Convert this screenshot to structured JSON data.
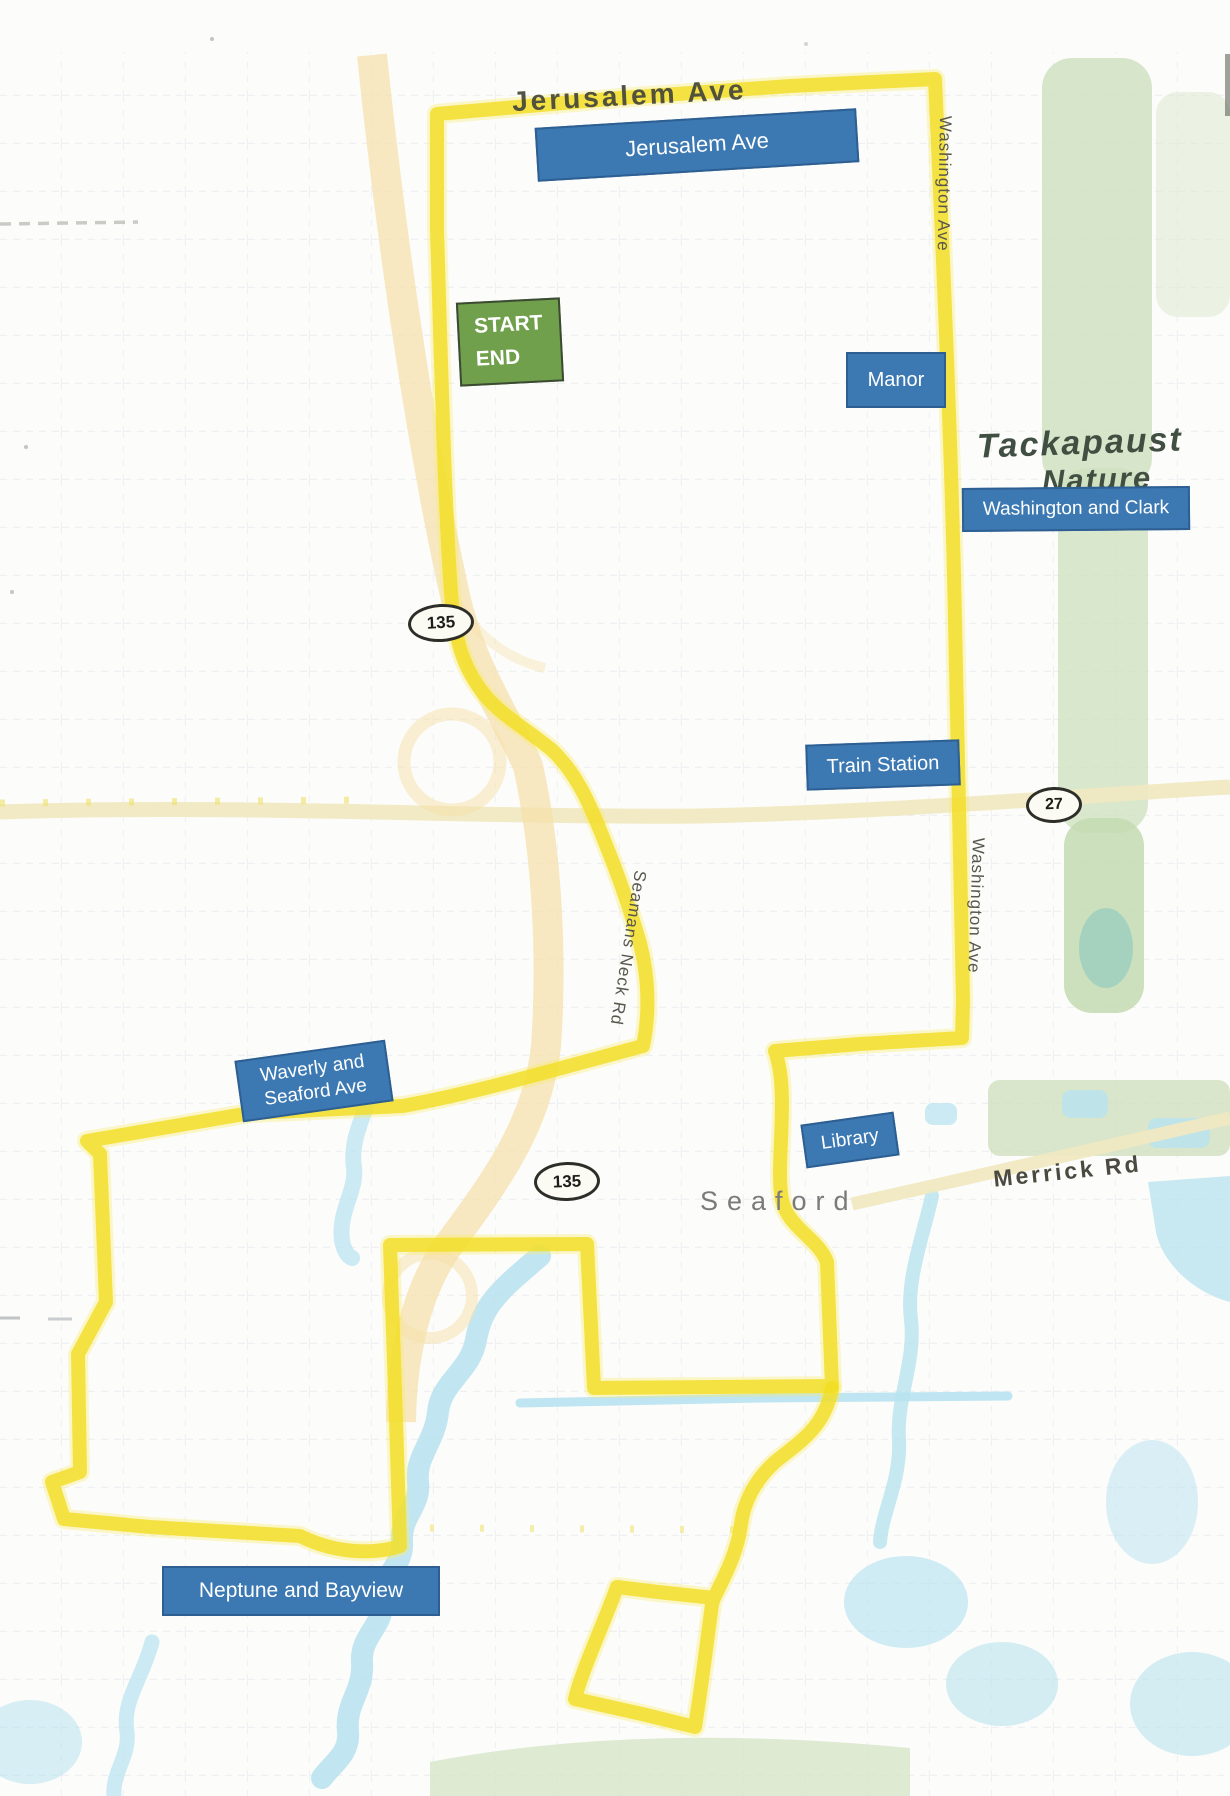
{
  "map": {
    "street_names": {
      "jerusalem_ave": "Jerusalem Ave",
      "washington_ave_north": "Washington Ave",
      "washington_ave_south": "Washington Ave",
      "seamans_neck_rd": "Seamans Neck Rd",
      "merrick_rd": "Merrick Rd"
    },
    "place_names": {
      "town": "Seaford",
      "preserve_line1": "Tackapaust",
      "preserve_line2": "Nature"
    },
    "shields": {
      "route_135_north": "135",
      "route_135_south": "135",
      "route_27": "27"
    },
    "route_stops": {
      "jerusalem_ave": "Jerusalem Ave",
      "manor": "Manor",
      "washington_and_clark": "Washington and Clark",
      "train_station": "Train Station",
      "waverly_line1": "Waverly and",
      "waverly_line2": "Seaford Ave",
      "library": "Library",
      "neptune_and_bayview": "Neptune and Bayview"
    },
    "start_marker": {
      "line1": "START",
      "line2": "END"
    },
    "colors": {
      "route_highlighter": "#f3dd22",
      "stop_label_fill": "#3c79b3",
      "stop_label_border": "#2e5f93",
      "start_marker_fill": "#70a04b",
      "water": "#b7e2ef",
      "park_green": "#cfe1c0",
      "parkway_orange": "#f6e0a8"
    }
  }
}
